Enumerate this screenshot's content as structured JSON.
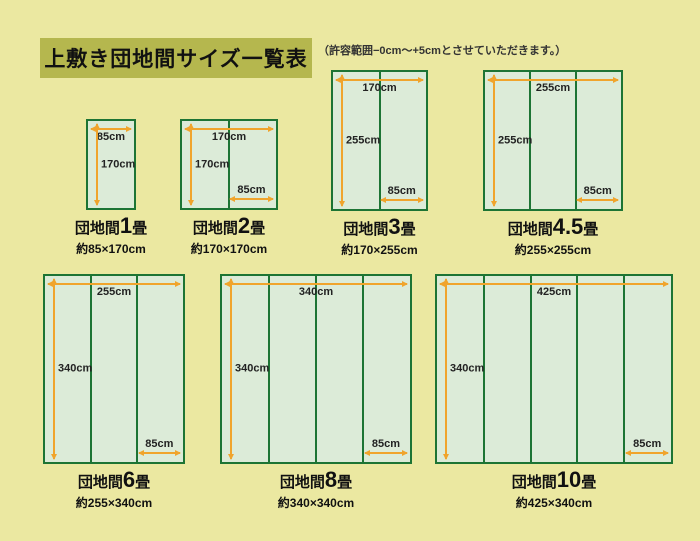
{
  "colors": {
    "page_bg": "#ebe8a1",
    "title_bg": "#b5b74e",
    "rug_border": "#1d7434",
    "rug_fill": "#dcebd8",
    "dimension_line": "#f0a42c",
    "label_text": "#222222",
    "caption_text": "#111111",
    "note_text": "#333333"
  },
  "header": {
    "title": "上敷き団地間サイズ一覧表",
    "note": "（許容範囲−0cm〜+5cmとさせていただきます。）"
  },
  "diagrams": [
    {
      "name_prefix": "団地間",
      "name_number": "1",
      "name_suffix": "畳",
      "size_label": "約85×170cm",
      "width_cm": 85,
      "height_cm": 170,
      "panels": 1,
      "width_label": "85cm",
      "height_label": "170cm",
      "panel_label": "",
      "box": {
        "left": 86,
        "top": 119,
        "width": 50,
        "height": 91
      }
    },
    {
      "name_prefix": "団地間",
      "name_number": "2",
      "name_suffix": "畳",
      "size_label": "約170×170cm",
      "width_cm": 170,
      "height_cm": 170,
      "panels": 2,
      "width_label": "170cm",
      "height_label": "170cm",
      "panel_label": "85cm",
      "box": {
        "left": 180,
        "top": 119,
        "width": 98,
        "height": 91
      }
    },
    {
      "name_prefix": "団地間",
      "name_number": "3",
      "name_suffix": "畳",
      "size_label": "約170×255cm",
      "width_cm": 170,
      "height_cm": 255,
      "panels": 2,
      "width_label": "170cm",
      "height_label": "255cm",
      "panel_label": "85cm",
      "box": {
        "left": 331,
        "top": 70,
        "width": 97,
        "height": 141
      }
    },
    {
      "name_prefix": "団地間",
      "name_number": "4.5",
      "name_suffix": "畳",
      "size_label": "約255×255cm",
      "width_cm": 255,
      "height_cm": 255,
      "panels": 3,
      "width_label": "255cm",
      "height_label": "255cm",
      "panel_label": "85cm",
      "box": {
        "left": 483,
        "top": 70,
        "width": 140,
        "height": 141
      }
    },
    {
      "name_prefix": "団地間",
      "name_number": "6",
      "name_suffix": "畳",
      "size_label": "約255×340cm",
      "width_cm": 255,
      "height_cm": 340,
      "panels": 3,
      "width_label": "255cm",
      "height_label": "340cm",
      "panel_label": "85cm",
      "box": {
        "left": 43,
        "top": 274,
        "width": 142,
        "height": 190
      }
    },
    {
      "name_prefix": "団地間",
      "name_number": "8",
      "name_suffix": "畳",
      "size_label": "約340×340cm",
      "width_cm": 340,
      "height_cm": 340,
      "panels": 4,
      "width_label": "340cm",
      "height_label": "340cm",
      "panel_label": "85cm",
      "box": {
        "left": 220,
        "top": 274,
        "width": 192,
        "height": 190
      }
    },
    {
      "name_prefix": "団地間",
      "name_number": "10",
      "name_suffix": "畳",
      "size_label": "約425×340cm",
      "width_cm": 425,
      "height_cm": 340,
      "panels": 5,
      "width_label": "425cm",
      "height_label": "340cm",
      "panel_label": "85cm",
      "box": {
        "left": 435,
        "top": 274,
        "width": 238,
        "height": 190
      }
    }
  ]
}
